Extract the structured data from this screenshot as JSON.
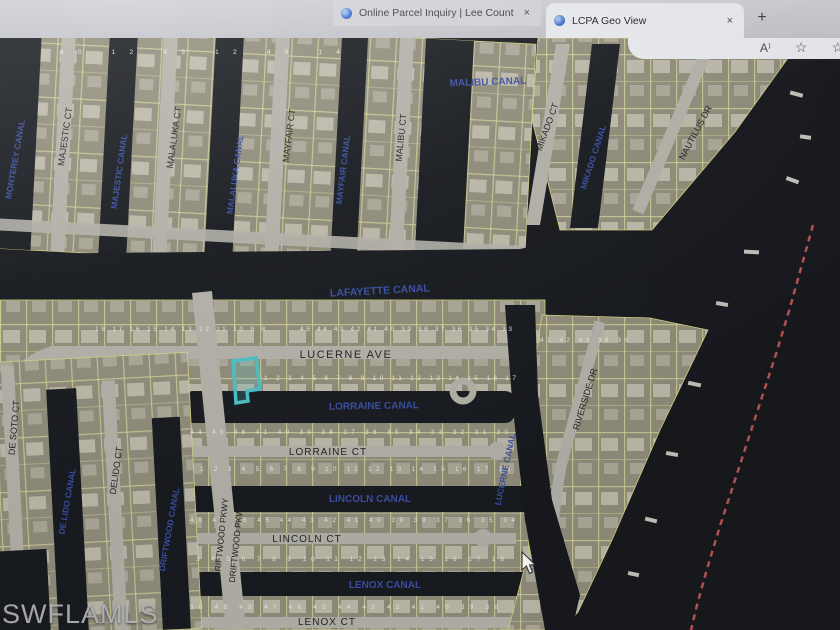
{
  "browser": {
    "tab1": {
      "title": "Online Parcel Inquiry | Lee County"
    },
    "tab2": {
      "title": "LCPA Geo View"
    },
    "icons": {
      "close": "×",
      "new_tab": "+",
      "read_aloud": "A⁾",
      "favorite": "☆",
      "collections": "☆"
    }
  },
  "watermark": "SWFLAMLS",
  "colors": {
    "highlight_parcel": "#2ec8cd",
    "boundary_line_red": "#e05050",
    "canal_label_blue": "#2e49b5",
    "water": "#0c0f15"
  },
  "map": {
    "labels": [
      {
        "text": "MALIBU CANAL"
      },
      {
        "text": "MONTEREY CANAL"
      },
      {
        "text": "MAJESTIC CT"
      },
      {
        "text": "MAJESTIC CANAL"
      },
      {
        "text": "MALALUKA CT"
      },
      {
        "text": "MALALUKA CANAL"
      },
      {
        "text": "MAYFAIR CT"
      },
      {
        "text": "MAYFAIR CANAL"
      },
      {
        "text": "MALIBU CT"
      },
      {
        "text": "MIKADO CT"
      },
      {
        "text": "MIKADO CANAL"
      },
      {
        "text": "NAUTILUS DR"
      },
      {
        "text": "LAFAYETTE CANAL"
      },
      {
        "text": "LUCERNE AVE"
      },
      {
        "text": "LORRAINE CANAL"
      },
      {
        "text": "LORRAINE CT"
      },
      {
        "text": "LINCOLN CANAL"
      },
      {
        "text": "LINCOLN CT"
      },
      {
        "text": "LENOX CANAL"
      },
      {
        "text": "LENOX CT"
      },
      {
        "text": "DE SOTO CT"
      },
      {
        "text": "DE LIDO CANAL"
      },
      {
        "text": "DELIDO CT"
      },
      {
        "text": "DRIFTWOOD CANAL"
      },
      {
        "text": "DRIFTWOOD PKWY"
      },
      {
        "text": "DRIFTWOOD PKWY"
      },
      {
        "text": "LUCERNE CANAL"
      },
      {
        "text": "RIVERSIDE DR"
      }
    ],
    "lot_rows": [
      {
        "text": "40 12 45 12 40 14"
      },
      {
        "text": "18 17 16 15 14 13 12 11 10 9 8"
      },
      {
        "text": "45 44 43 42 41 40 39 38 37 36 35 34 33"
      },
      {
        "text": "1 2 3 4 5 6 7 8 9 10 11 12 13 14 15 16 17"
      },
      {
        "text": "44 45 46 41 40 39 38 37 36 35 34 33 32 31 30"
      },
      {
        "text": "1 2 3 4 5 6 7 8 9 10 11 12 13 14 15 16 17 18"
      },
      {
        "text": "48 47 46 45 44 43 42 41 40 39 38 37 36 35 34"
      },
      {
        "text": "3 4 5 6 7 8 9 10 11 12 13 14 15 16 17 18"
      },
      {
        "text": "50 49 48 47 46 45 44 43 42 41 40 39 38"
      },
      {
        "text": "41 42 43 38 36"
      }
    ]
  }
}
